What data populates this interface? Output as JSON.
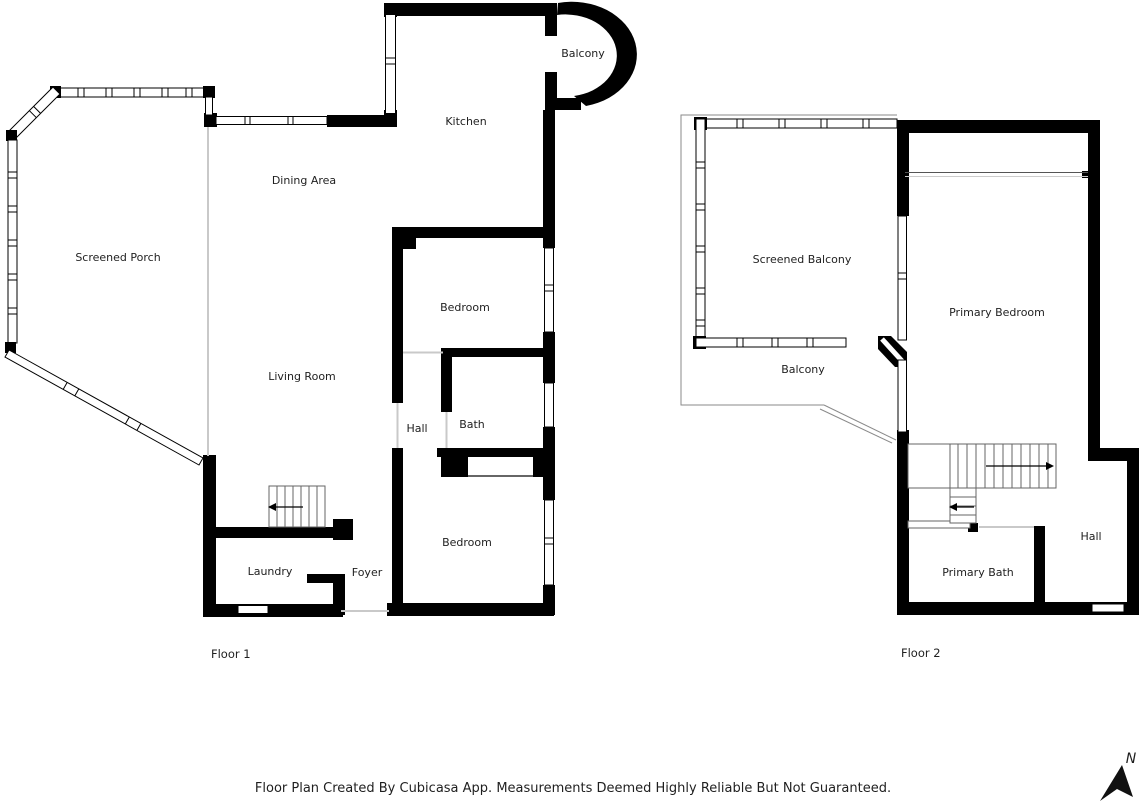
{
  "footer": {
    "note": "Floor Plan Created By Cubicasa App. Measurements Deemed Highly Reliable But Not Guaranteed."
  },
  "compass": {
    "north_label": "N"
  },
  "floor1": {
    "title": "Floor 1",
    "rooms": {
      "screened_porch": "Screened Porch",
      "dining_area": "Dining Area",
      "kitchen": "Kitchen",
      "balcony": "Balcony",
      "bedroom": "Bedroom",
      "living_room": "Living Room",
      "hall": "Hall",
      "bath": "Bath",
      "laundry": "Laundry",
      "foyer": "Foyer"
    }
  },
  "floor2": {
    "title": "Floor 2",
    "rooms": {
      "screened_balcony": "Screened Balcony",
      "primary_bedroom": "Primary Bedroom",
      "balcony": "Balcony",
      "primary_bath": "Primary Bath",
      "hall": "Hall"
    }
  },
  "colors": {
    "wall": "#000000",
    "opening_line": "#c9c9c9",
    "deck_outline": "#8a8a8a",
    "stair_line": "#666666",
    "label_text": "#1f1f1f"
  }
}
